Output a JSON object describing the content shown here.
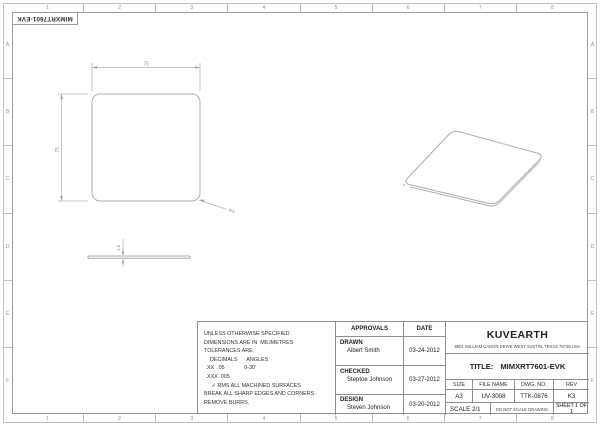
{
  "sheet": {
    "zone_columns": [
      "1",
      "2",
      "3",
      "4",
      "5",
      "6",
      "7",
      "8"
    ],
    "zone_rows": [
      "A",
      "B",
      "C",
      "D",
      "E",
      "F"
    ],
    "corner_label": "MIMXRT7601-EVK"
  },
  "dimensions": {
    "width": "75",
    "height": "75",
    "corner_radius": "R3",
    "thickness": "1.6"
  },
  "notes": {
    "lines": [
      "UNLESS OTHERWISE SPECIFIED",
      "DIMENSIONS ARE IN  MILIMETRES",
      "TOLERANCES ARE:",
      "    DECIMALS      ANGLES",
      " .XX  .05             0-30'",
      " .XXX .005",
      "     ✓ RMS ALL MACHINED SURFACES",
      "BREAK ALL SHARP EDGES AND CORNERS.",
      "REMOVE BURRS."
    ]
  },
  "approvals": {
    "header": {
      "approvals": "APPROVALS",
      "date": "DATE"
    },
    "rows": [
      {
        "role": "DRAWN",
        "name": "Albert Smith",
        "date": "03-24-2012"
      },
      {
        "role": "CHECKED",
        "name": "Steptoe Johnson",
        "date": "03-27-2012"
      },
      {
        "role": "DESIGN",
        "name": "Steven Johnson",
        "date": "03-20-2012"
      }
    ]
  },
  "company": {
    "name": "KUVEARTH",
    "address": "9501 WILLIAM CANON DRIVE WEST AUSTIN, TEXAS 78735 USA",
    "title_label": "TITLE:",
    "title_value": "MIMXRT7601-EVK"
  },
  "info": {
    "size_label": "SIZE",
    "size": "A3",
    "file_name_label": "FILE NAME",
    "file_name": "UV-3008",
    "dwg_no_label": "DWG. NO.",
    "dwg_no": "TTK-0876",
    "rev_label": "REV",
    "rev": "K3",
    "scale": "SCALE 2/1",
    "no_scale": "DO NOT SCALE DRAWING",
    "sheet": "SHEET 1 OF 1"
  }
}
